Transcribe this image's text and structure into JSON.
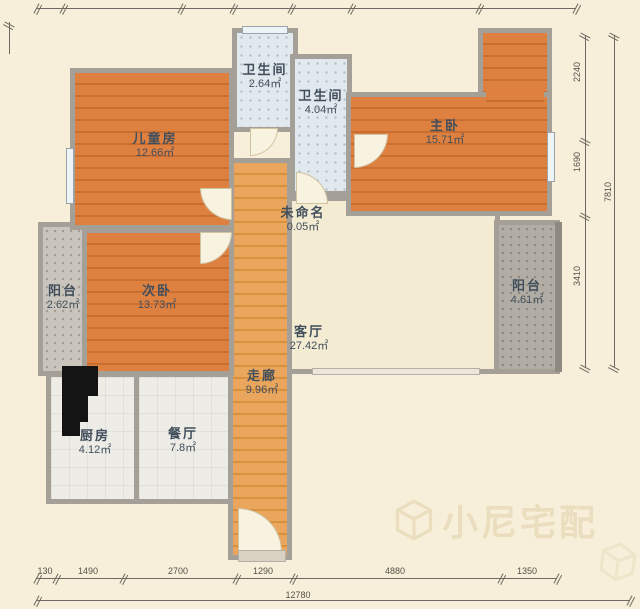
{
  "rooms": [
    {
      "name": "儿童房",
      "area": "12.66㎡"
    },
    {
      "name": "卫生间",
      "area": "2.64㎡"
    },
    {
      "name": "卫生间",
      "area": "4.04㎡"
    },
    {
      "name": "主卧",
      "area": "15.71㎡"
    },
    {
      "name": "未命名",
      "area": "0.05㎡"
    },
    {
      "name": "次卧",
      "area": "13.73㎡"
    },
    {
      "name": "阳台",
      "area": "2.62㎡"
    },
    {
      "name": "客厅",
      "area": "27.42㎡"
    },
    {
      "name": "阳台",
      "area": "4.61㎡"
    },
    {
      "name": "走廊",
      "area": "9.96㎡"
    },
    {
      "name": "厨房",
      "area": "4.12㎡"
    },
    {
      "name": "餐厅",
      "area": "7.8㎡"
    }
  ],
  "dimensions": {
    "bottom": {
      "segments": [
        "130",
        "1490",
        "2700",
        "1290",
        "4880",
        "1350"
      ],
      "total": "12780"
    },
    "right": {
      "segments": [
        "2240",
        "1690",
        "3410"
      ],
      "total": "7810"
    }
  },
  "watermark": {
    "text": "小尼宅配"
  },
  "colors": {
    "wood_floor": "#de8040",
    "corridor_floor": "#e9a65c",
    "wall": "#a49f97",
    "background": "#f7efd9",
    "bath_tile": "#e2e9ee",
    "label_text": "#414e5b"
  }
}
